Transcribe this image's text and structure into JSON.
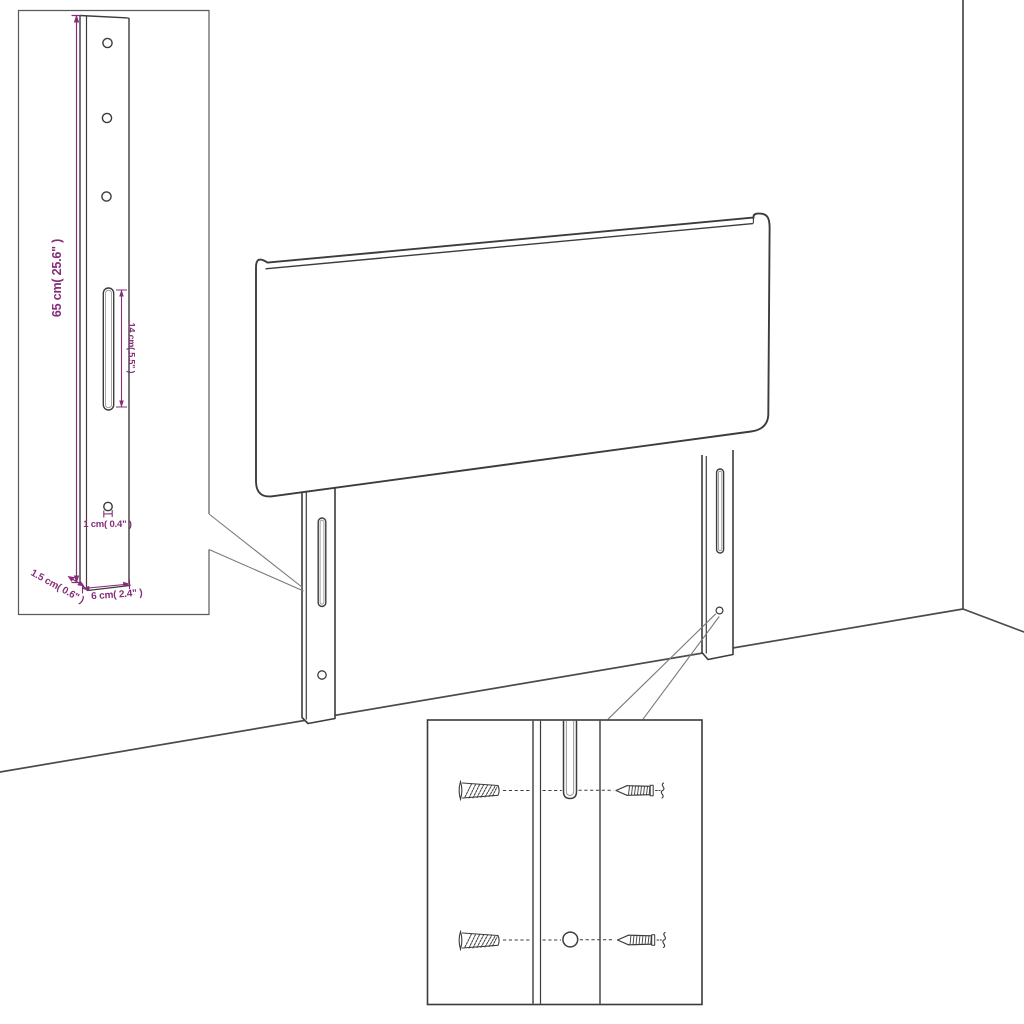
{
  "colors": {
    "outline": "#3c3c3c",
    "wall_line": "#4b4b4b",
    "callout_line": "#7a7a7a",
    "dimension_accent": "#862d78",
    "inset_border": "#5a5a5a",
    "background": "#ffffff"
  },
  "leg_detail_inset": {
    "height_label": "65 cm( 25.6\" )",
    "slot_length_label": "14 cm( 5.5\" )",
    "hole_diameter_label": "1 cm( 0.4\" )",
    "thickness_label": "1.5 cm( 0.6\" )",
    "width_label": "6 cm( 2.4\" )"
  }
}
